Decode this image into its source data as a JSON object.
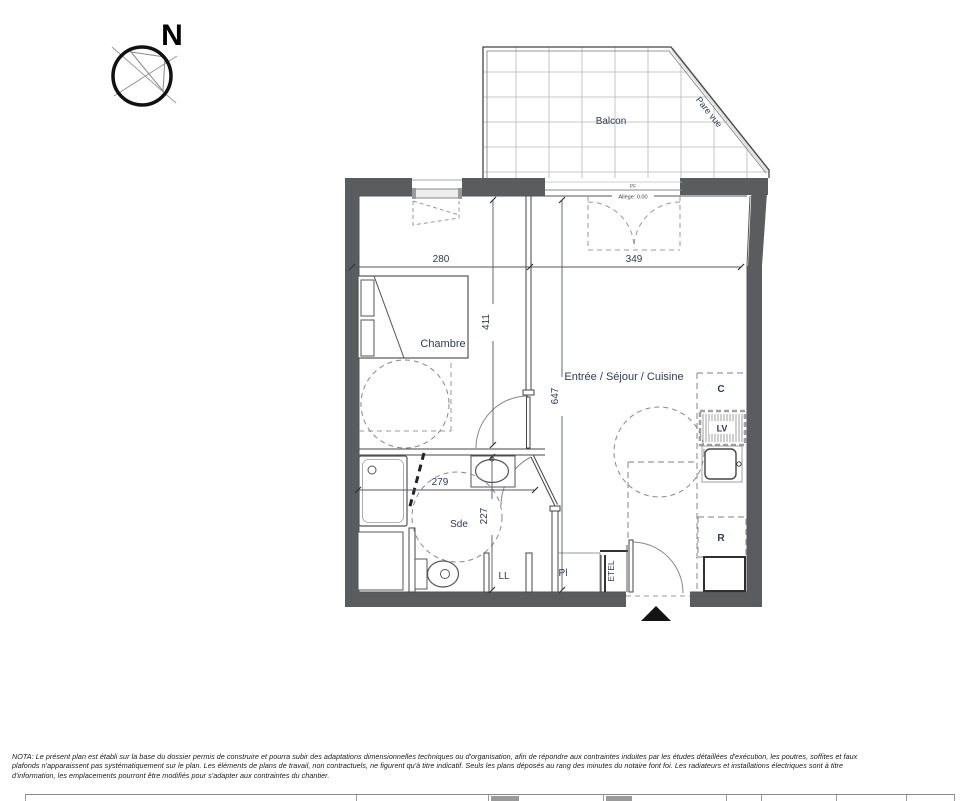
{
  "compass": {
    "north": "N"
  },
  "rooms": {
    "balcony": "Balcon",
    "bedroom": "Chambre",
    "living": "Entrée / Séjour / Cuisine",
    "shower_room": "Sde"
  },
  "annotations": {
    "privacy_screen": "Pare vue",
    "window_tag": "PF",
    "sill_height": "Allège: 0.00",
    "cupboard": "C",
    "dishwasher": "LV",
    "fridge": "R",
    "washing_machine": "LL",
    "closet": "Pl",
    "electrical_box": "ETEL"
  },
  "dimensions_cm": {
    "bedroom_width": "280",
    "living_width": "349",
    "bedroom_length": "411",
    "living_length": "647",
    "shower_room_width": "279",
    "shower_room_length": "227"
  },
  "nota": {
    "line1": "NOTA: Le présent plan est établi sur la base du dossier permis de construire et pourra subir des adaptations dimensionnelles techniques ou d'organisation, afin de répondre aux contraintes induites par les études détaillées d'exécution, les poutres, soffites et faux",
    "line2": "plafonds n'apparaissent pas systématiquement sur le plan. Les éléments de plans de travail, non contractuels, ne figurent qu'à titre indicatif. Seuls les plans déposés au rang des minutes du notaire font foi. Les radiateurs et installations électriques sont à titre",
    "line3": "d'information, les emplacements pourront être modifiés pour s'adapter aux contraintes du chantier."
  },
  "colors": {
    "wall": "#5b5c5e",
    "label": "#2e3a59",
    "line": "#555555"
  }
}
